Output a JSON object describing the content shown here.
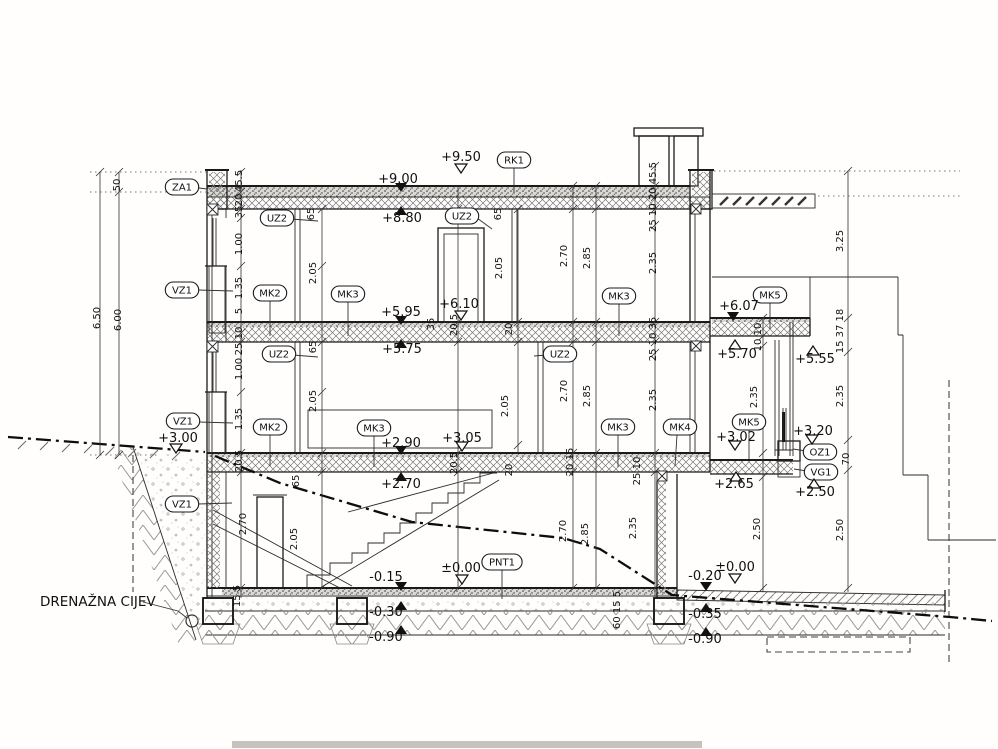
{
  "drawing": {
    "callout": {
      "text": "DRENAŽNA CIJEV"
    },
    "tags": [
      {
        "label": "ZA1",
        "x": 182,
        "y": 187,
        "leader": [
          199,
          188,
          207,
          189
        ]
      },
      {
        "label": "RK1",
        "x": 514,
        "y": 160,
        "leader": [
          514,
          168,
          514,
          193
        ]
      },
      {
        "label": "UZ2",
        "x": 277,
        "y": 218,
        "leader": [
          291,
          219,
          318,
          221
        ]
      },
      {
        "label": "UZ2",
        "x": 462,
        "y": 216,
        "leader": [
          477,
          218,
          492,
          229
        ]
      },
      {
        "label": "UZ2",
        "x": 279,
        "y": 354,
        "leader": [
          293,
          355,
          318,
          357
        ]
      },
      {
        "label": "UZ2",
        "x": 560,
        "y": 354,
        "leader": [
          546,
          355,
          534,
          356
        ]
      },
      {
        "label": "VZ1",
        "x": 182,
        "y": 290,
        "leader": [
          198,
          290,
          233,
          291
        ]
      },
      {
        "label": "VZ1",
        "x": 183,
        "y": 421,
        "leader": [
          199,
          422,
          233,
          423
        ]
      },
      {
        "label": "VZ1",
        "x": 182,
        "y": 504,
        "leader": [
          198,
          504,
          232,
          503
        ]
      },
      {
        "label": "MK2",
        "x": 270,
        "y": 293,
        "leader": [
          270,
          301,
          270,
          336
        ]
      },
      {
        "label": "MK2",
        "x": 270,
        "y": 427,
        "leader": [
          270,
          435,
          270,
          466
        ]
      },
      {
        "label": "MK3",
        "x": 348,
        "y": 294,
        "leader": [
          348,
          302,
          348,
          336
        ]
      },
      {
        "label": "MK3",
        "x": 619,
        "y": 296,
        "leader": [
          619,
          304,
          619,
          336
        ]
      },
      {
        "label": "MK3",
        "x": 374,
        "y": 428,
        "leader": [
          374,
          436,
          374,
          467
        ]
      },
      {
        "label": "MK3",
        "x": 618,
        "y": 427,
        "leader": [
          618,
          435,
          618,
          467
        ]
      },
      {
        "label": "MK4",
        "x": 680,
        "y": 427,
        "leader": [
          677,
          435,
          675,
          466
        ]
      },
      {
        "label": "MK5",
        "x": 770,
        "y": 295,
        "leader": [
          770,
          303,
          770,
          329
        ]
      },
      {
        "label": "MK5",
        "x": 749,
        "y": 422,
        "leader": [
          749,
          430,
          749,
          459
        ]
      },
      {
        "label": "OZ1",
        "x": 820,
        "y": 452,
        "leader": [
          806,
          451,
          793,
          449
        ]
      },
      {
        "label": "VG1",
        "x": 821,
        "y": 472,
        "leader": [
          807,
          471,
          794,
          469
        ]
      },
      {
        "label": "PNT1",
        "x": 502,
        "y": 562,
        "leader": [
          502,
          570,
          502,
          599
        ]
      }
    ],
    "elevations": [
      {
        "text": "+9.50",
        "m": "od",
        "tx": 461,
        "ty": 161,
        "mx": 461,
        "my": 173
      },
      {
        "text": "+9.00",
        "m": "fd",
        "tx": 398,
        "ty": 183,
        "mx": 401,
        "my": 192
      },
      {
        "text": "+8.80",
        "m": "fu",
        "tx": 402,
        "ty": 222,
        "mx": 401,
        "my": 206
      },
      {
        "text": "+6.10",
        "m": "od",
        "tx": 459,
        "ty": 308,
        "mx": 461,
        "my": 320
      },
      {
        "text": "+5.95",
        "m": "fd",
        "tx": 401,
        "ty": 316,
        "mx": 401,
        "my": 325
      },
      {
        "text": "+5.75",
        "m": "fu",
        "tx": 402,
        "ty": 353,
        "mx": 401,
        "my": 339
      },
      {
        "text": "+6.07",
        "m": "fd",
        "tx": 739,
        "ty": 310,
        "mx": 733,
        "my": 321
      },
      {
        "text": "+5.70",
        "m": "ou",
        "tx": 737,
        "ty": 358,
        "mx": 735,
        "my": 340
      },
      {
        "text": "+5.55",
        "m": "ou",
        "tx": 815,
        "ty": 363,
        "mx": 813,
        "my": 346
      },
      {
        "text": "+3.00",
        "m": "od",
        "tx": 178,
        "ty": 442,
        "mx": 176,
        "my": 453
      },
      {
        "text": "+2.90",
        "m": "fd",
        "tx": 401,
        "ty": 447,
        "mx": 401,
        "my": 455
      },
      {
        "text": "+3.05",
        "m": "od",
        "tx": 462,
        "ty": 442,
        "mx": 462,
        "my": 451
      },
      {
        "text": "+2.70",
        "m": "fu",
        "tx": 401,
        "ty": 488,
        "mx": 401,
        "my": 472
      },
      {
        "text": "+3.20",
        "m": "od",
        "tx": 813,
        "ty": 435,
        "mx": 812,
        "my": 444
      },
      {
        "text": "+3.02",
        "m": "od",
        "tx": 736,
        "ty": 441,
        "mx": 735,
        "my": 450
      },
      {
        "text": "+2.65",
        "m": "ou",
        "tx": 734,
        "ty": 488,
        "mx": 736,
        "my": 472
      },
      {
        "text": "+2.50",
        "m": "ou",
        "tx": 815,
        "ty": 496,
        "mx": 814,
        "my": 479
      },
      {
        "text": "-0.15",
        "m": "fd",
        "tx": 386,
        "ty": 581,
        "mx": 401,
        "my": 591
      },
      {
        "text": "±0.00",
        "m": "od",
        "tx": 461,
        "ty": 572,
        "mx": 462,
        "my": 584
      },
      {
        "text": "-0.30",
        "m": "fu",
        "tx": 386,
        "ty": 616,
        "mx": 401,
        "my": 601
      },
      {
        "text": "-0.90",
        "m": "fu",
        "tx": 386,
        "ty": 641,
        "mx": 401,
        "my": 625
      },
      {
        "text": "-0.20",
        "m": "fd",
        "tx": 705,
        "ty": 580,
        "mx": 706,
        "my": 591
      },
      {
        "text": "±0.00",
        "m": "od",
        "tx": 735,
        "ty": 571,
        "mx": 735,
        "my": 583
      },
      {
        "text": "-0.35",
        "m": "fu",
        "tx": 705,
        "ty": 618,
        "mx": 706,
        "my": 603
      },
      {
        "text": "-0.90",
        "m": "fu",
        "tx": 705,
        "ty": 643,
        "mx": 706,
        "my": 627
      }
    ],
    "dims": [
      {
        "t": "50",
        "x": 120,
        "y": 185
      },
      {
        "t": "6.50",
        "x": 100,
        "y": 318
      },
      {
        "t": "6.00",
        "x": 121,
        "y": 320
      },
      {
        "t": "45.5",
        "x": 242,
        "y": 181
      },
      {
        "t": "20",
        "x": 242,
        "y": 200
      },
      {
        "t": "35",
        "x": 242,
        "y": 212
      },
      {
        "t": "1.00",
        "x": 242,
        "y": 244
      },
      {
        "t": "1.35",
        "x": 242,
        "y": 288
      },
      {
        "t": "5",
        "x": 242,
        "y": 311
      },
      {
        "t": "25 10",
        "x": 242,
        "y": 341
      },
      {
        "t": "1.00",
        "x": 242,
        "y": 369
      },
      {
        "t": "1.35",
        "x": 242,
        "y": 419
      },
      {
        "t": "20.5",
        "x": 242,
        "y": 461
      },
      {
        "t": "2.70",
        "x": 246,
        "y": 524
      },
      {
        "t": "15 5",
        "x": 240,
        "y": 596
      },
      {
        "t": "65",
        "x": 314,
        "y": 214
      },
      {
        "t": "2.05",
        "x": 316,
        "y": 273
      },
      {
        "t": "65",
        "x": 316,
        "y": 347
      },
      {
        "t": "2.05",
        "x": 316,
        "y": 401
      },
      {
        "t": "65",
        "x": 299,
        "y": 481
      },
      {
        "t": "2.05",
        "x": 297,
        "y": 539
      },
      {
        "t": "35",
        "x": 434,
        "y": 324
      },
      {
        "t": "20.5",
        "x": 457,
        "y": 325
      },
      {
        "t": "20",
        "x": 512,
        "y": 329
      },
      {
        "t": "65",
        "x": 501,
        "y": 214
      },
      {
        "t": "2.05",
        "x": 502,
        "y": 268
      },
      {
        "t": "2.70",
        "x": 567,
        "y": 256
      },
      {
        "t": "2.85",
        "x": 590,
        "y": 258
      },
      {
        "t": "2.35",
        "x": 656,
        "y": 263
      },
      {
        "t": "25 10 20 45.5",
        "x": 656,
        "y": 197
      },
      {
        "t": "20.5",
        "x": 457,
        "y": 463
      },
      {
        "t": "20",
        "x": 512,
        "y": 470
      },
      {
        "t": "20 15",
        "x": 573,
        "y": 462
      },
      {
        "t": "25 10 35",
        "x": 656,
        "y": 339
      },
      {
        "t": "2.05",
        "x": 508,
        "y": 406
      },
      {
        "t": "2.70",
        "x": 567,
        "y": 391
      },
      {
        "t": "2.85",
        "x": 590,
        "y": 396
      },
      {
        "t": "2.35",
        "x": 656,
        "y": 400
      },
      {
        "t": "25 10",
        "x": 640,
        "y": 471
      },
      {
        "t": "2.35",
        "x": 636,
        "y": 528
      },
      {
        "t": "2.70",
        "x": 566,
        "y": 531
      },
      {
        "t": "2.85",
        "x": 588,
        "y": 534
      },
      {
        "t": "60 15 5",
        "x": 620,
        "y": 610
      },
      {
        "t": "10 10",
        "x": 761,
        "y": 337
      },
      {
        "t": "2.35",
        "x": 757,
        "y": 397
      },
      {
        "t": "2.50",
        "x": 760,
        "y": 529
      },
      {
        "t": "3.25",
        "x": 843,
        "y": 241
      },
      {
        "t": "15 37 18",
        "x": 843,
        "y": 331
      },
      {
        "t": "2.35",
        "x": 843,
        "y": 396
      },
      {
        "t": "70",
        "x": 849,
        "y": 459
      },
      {
        "t": "2.50",
        "x": 843,
        "y": 530
      }
    ]
  }
}
